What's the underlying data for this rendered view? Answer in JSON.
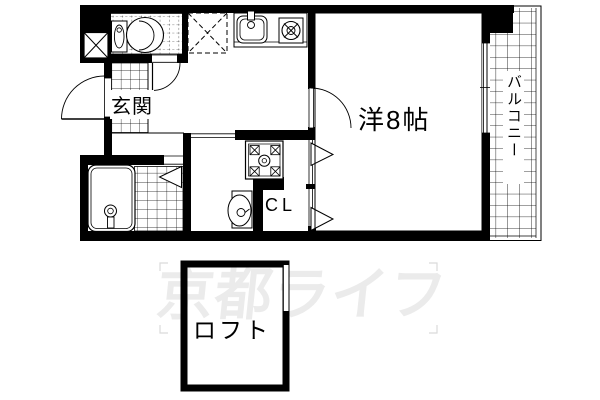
{
  "labels": {
    "genkan": "玄関",
    "main_room": "洋8帖",
    "closet": "CL",
    "balcony": "バルコニー",
    "loft": "ロフト"
  },
  "watermark": {
    "text": "京都ライフ",
    "color": "#ebebeb"
  },
  "colors": {
    "line": "#000000",
    "background": "#ffffff"
  },
  "fixtures": {
    "pipe_shaft": "pipe-shaft-x-icon",
    "toilet": "toilet-icon",
    "refrigerator_space": "refrigerator-space-dashed-x-icon",
    "kitchen_sink": "kitchen-sink-icon",
    "gas_burner": "gas-burner-icon",
    "bathtub": "bathtub-icon",
    "washing_machine_pan": "washing-machine-pan-icon",
    "washbasin": "washbasin-icon",
    "entrance_door": "door-swing-arc-icon",
    "closet_doors": "folding-door-icon"
  }
}
